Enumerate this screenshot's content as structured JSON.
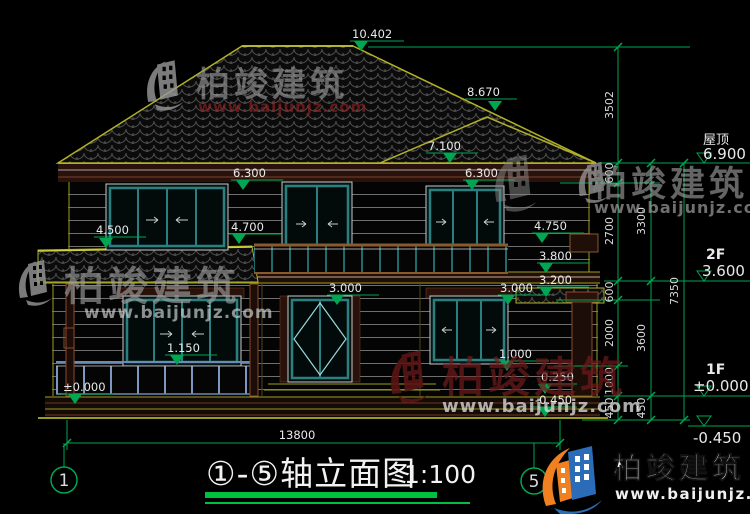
{
  "drawing": {
    "title": "①-⑤轴立面图",
    "scale": "1:100",
    "width_dim": "13800",
    "axis_left": "1",
    "axis_right": "5"
  },
  "levels": {
    "l10402": "10.402",
    "l8670": "8.670",
    "l7100": "7.100",
    "l6300a": "6.300",
    "l6300b": "6.300",
    "l4500": "4.500",
    "l4700": "4.700",
    "l4750": "4.750",
    "l3800": "3.800",
    "l3200": "3.200",
    "l3000a": "3.000",
    "l3000b": "3.000",
    "l1150": "1.150",
    "l1000": "1.000",
    "l0000": "±0.000",
    "l0250": "0.250",
    "lm0450": "-0.450"
  },
  "right_labels": {
    "roof_label": "屋顶",
    "roof_value": "6.900",
    "f2_label": "2F",
    "f2_value": "3.600",
    "f1_label": "1F",
    "f1_value": "±0.000",
    "ground_value": "-0.450"
  },
  "dim_chain_inner": [
    "3502",
    "600",
    "2700",
    "600",
    "2000",
    "1000",
    "450"
  ],
  "dim_chain_mid": [
    "3300",
    "3600",
    "450"
  ],
  "dim_chain_outer": [
    "7350"
  ],
  "watermark": {
    "brand": "柏竣建筑",
    "url": "www.baijunjz.com"
  },
  "logo": {
    "brand": "柏竣建筑",
    "url": "www.baijunjz.com"
  },
  "colors": {
    "dim_green": "#00A651",
    "line_yellow": "#9a9a20",
    "window_teal": "#2a8080",
    "wall_maroon": "#5a2418",
    "logo_blue": "#2b6cb8",
    "logo_orange": "#f08020",
    "watermark_red": "#6e1b1b"
  }
}
